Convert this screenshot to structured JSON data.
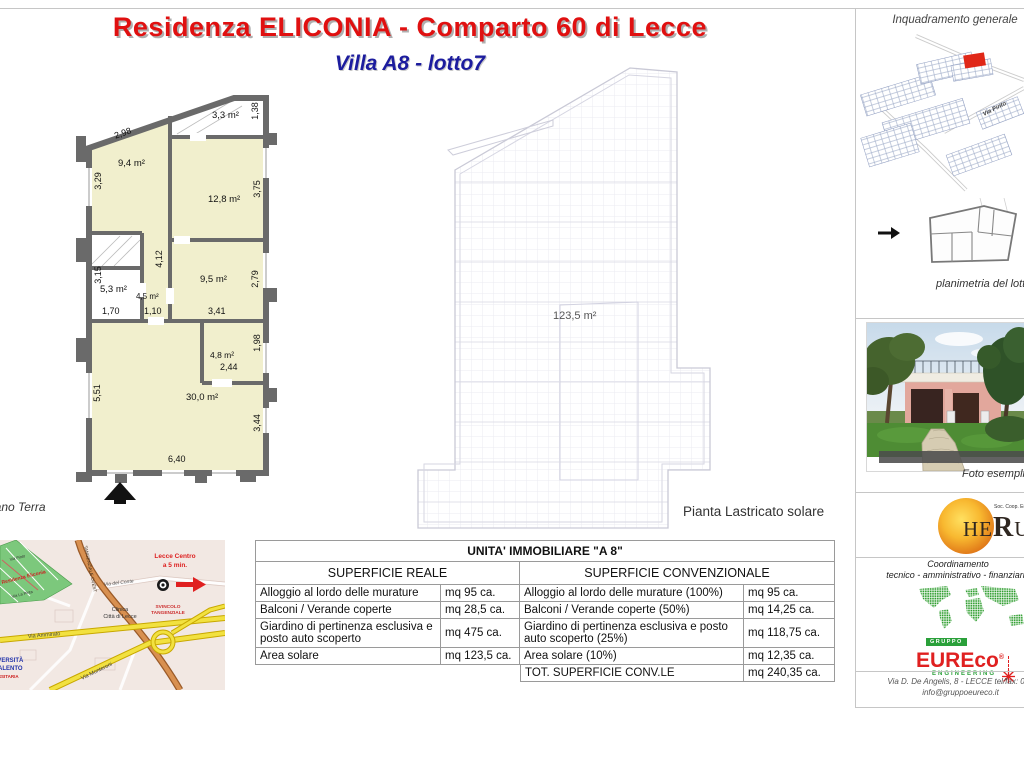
{
  "header": {
    "title": "Residenza ELICONIA - Comparto 60 di Lecce",
    "subtitle": "Villa A8 - lotto7",
    "title_color": "#e01010",
    "subtitle_color": "#1c1c9e"
  },
  "floor_plan": {
    "caption": "Piano Terra",
    "rooms": {
      "r33": "3,3 m²",
      "r94": "9,4 m²",
      "r128": "12,8 m²",
      "r53": "5,3 m²",
      "r45": "4,5 m²",
      "r95": "9,5 m²",
      "r48": "4,8 m²",
      "r300": "30,0 m²"
    },
    "dims": {
      "d298": "2,98",
      "d138": "1,38",
      "d329": "3,29",
      "d375": "3,75",
      "d412": "4,12",
      "d279": "2,79",
      "d315": "3,15",
      "d170": "1,70",
      "d110": "1,10",
      "d341": "3,41",
      "d244": "2,44",
      "d198": "1,98",
      "d551": "5,51",
      "d344": "3,44",
      "d640": "6,40"
    }
  },
  "lastricato": {
    "area": "123,5 m²",
    "caption": "Pianta Lastricato solare"
  },
  "sidebar": {
    "inquadramento": {
      "title": "Inquadramento generale",
      "street": "Via Pinto"
    },
    "planimetria": {
      "caption": "planimetria del lotto"
    },
    "photo": {
      "caption": "Foto esemplificativa"
    },
    "herus": {
      "he": "HE",
      "r": "R",
      "us": "US",
      "small": "Soc. Coop. Edilizia"
    },
    "coordinamento": {
      "l1": "Coordinamento",
      "l2": "tecnico - amministrativo - finanziario"
    },
    "eureco": {
      "gruppo": "GRUPPO",
      "name": "EUREco",
      "reg": "®",
      "sub": "ENGINEERING",
      "address": "Via D. De Angelis, 8 - LECCE   tel/fax: 083",
      "email": "info@gruppoeureco.it"
    }
  },
  "site_map": {
    "via_pinto": "Via Pinto",
    "residenza": "Residenza Eliconia",
    "via_la_pinta": "Via La Pinta",
    "tangenziale": "TANGENZIALE OVEST",
    "via_del_conte": "Via del Conte",
    "clinica1": "Clinica",
    "clinica2": "Città di Lecce",
    "lecce1": "Lecce Centro",
    "lecce2": "a 5 min.",
    "via_ammirato": "Via Ammirato",
    "svincolo1": "SVINCOLO",
    "svincolo2": "TANGENZIALE",
    "via_monteroni": "Via Monteroni",
    "universita1": "UNIVERSITÀ",
    "universita2": "SALENTO",
    "universita3": "UNIVERSITARIA"
  },
  "table": {
    "title": "UNITA' IMMOBILIARE  \"A 8\"",
    "col_real": "SUPERFICIE REALE",
    "col_conv": "SUPERFICIE CONVENZIONALE",
    "rows": [
      {
        "label_real": "Alloggio al lordo delle murature",
        "val_real": "mq 95 ca.",
        "label_conv": "Alloggio al lordo delle murature (100%)",
        "val_conv": "mq 95 ca."
      },
      {
        "label_real": "Balconi / Verande coperte",
        "val_real": "mq 28,5 ca.",
        "label_conv": "Balconi / Verande coperte (50%)",
        "val_conv": "mq 14,25 ca."
      },
      {
        "label_real": "Giardino di pertinenza esclusiva e posto auto scoperto",
        "val_real": "mq 475 ca.",
        "label_conv": "Giardino di pertinenza esclusiva e posto auto scoperto (25%)",
        "val_conv": "mq 118,75 ca."
      },
      {
        "label_real": "Area solare",
        "val_real": "mq 123,5 ca.",
        "label_conv": "Area solare (10%)",
        "val_conv": "mq 12,35 ca."
      },
      {
        "label_real": "",
        "val_real": "",
        "label_conv": "TOT. SUPERFICIE CONV.LE",
        "val_conv": "mq 240,35 ca."
      }
    ]
  }
}
